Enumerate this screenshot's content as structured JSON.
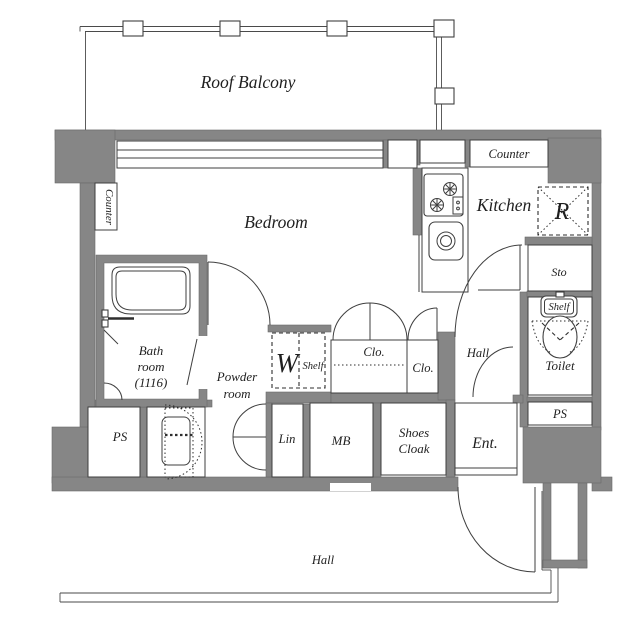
{
  "plan": {
    "title": "apartment-floor-plan",
    "colors": {
      "wall": "#868686",
      "line": "#3f3f3f",
      "text": "#1f1f1f",
      "background": "#ffffff"
    },
    "labels": {
      "roof_balcony": "Roof Balcony",
      "bedroom": "Bedroom",
      "kitchen": "Kitchen",
      "counter_kitchen": "Counter",
      "counter_bedroom": "Counter",
      "refrigerator": "R",
      "storage": "Sto",
      "toilet_shelf": "Shelf",
      "toilet": "Toilet",
      "ps_right": "PS",
      "ps_left": "PS",
      "bath": [
        "Bath",
        "room",
        "(1116)"
      ],
      "powder": [
        "Powder",
        "room"
      ],
      "washer": "W",
      "washer_shelf": "Shelf",
      "closet_left": "Clo.",
      "closet_right": "Clo.",
      "hall_inner": "Hall",
      "linen": "Lin",
      "meter_box": "MB",
      "shoes_cloak": [
        "Shoes",
        "Cloak"
      ],
      "entrance": "Ent.",
      "hall_outer": "Hall"
    }
  }
}
